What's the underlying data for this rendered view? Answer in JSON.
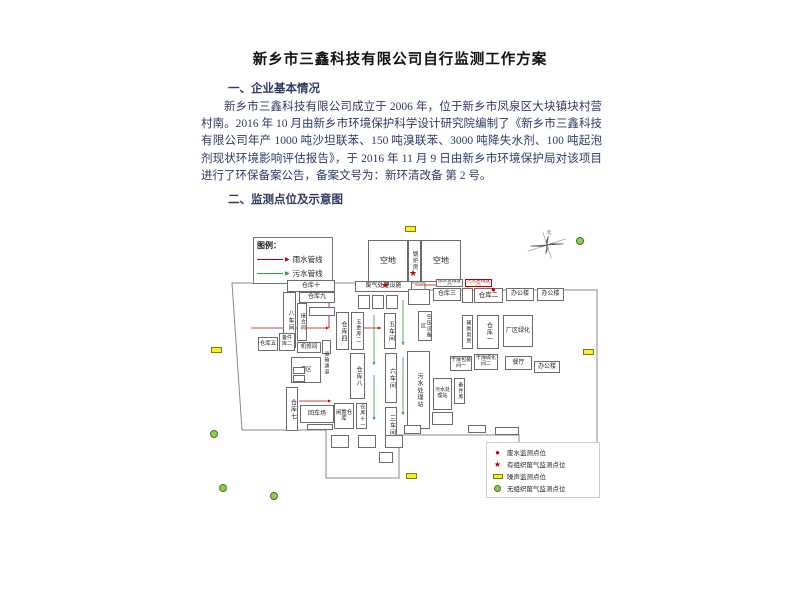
{
  "document": {
    "title": "新乡市三鑫科技有限公司自行监测工作方案",
    "section1_heading": "一、企业基本情况",
    "paragraph": "新乡市三鑫科技有限公司成立于 2006 年，位于新乡市凤泉区大块镇块村营村南。2016 年 10 月由新乡市环境保护科学设计研究院编制了《新乡市三鑫科技有限公司年产 1000 吨沙坦联苯、150 吨溴联苯、3000 吨降失水剂、100 吨起泡剂现状环境影响评估报告》，于 2016 年 11 月 9 日由新乡市环境保护局对该项目进行了环保备案公告，备案文号为：新环清改备 第 2 号。",
    "section2_heading": "二、监测点位及示意图",
    "text_color": "#2e3a66",
    "title_color": "#111111"
  },
  "diagram": {
    "palette": {
      "rain": "#c00000",
      "sewage": "#2e9e44",
      "noise_fill": "#f5ef2a",
      "noise_border": "#7f7f00",
      "fugitive_fill": "#92c94e",
      "fugitive_border": "#3c7a1f",
      "star": "#c00000",
      "dot": "#c00000",
      "outline": "#8a8a8a"
    },
    "pipe_legend": {
      "title": "图例：",
      "items": [
        {
          "label": "雨水管线",
          "color_key": "rain"
        },
        {
          "label": "污水管线",
          "color_key": "sewage"
        }
      ]
    },
    "monitoring_legend": {
      "items": [
        {
          "label": "废水监测点位",
          "symbol": "dot"
        },
        {
          "label": "有组织废气监测点位",
          "symbol": "star"
        },
        {
          "label": "噪声监测点位",
          "symbol": "noise"
        },
        {
          "label": "无组织废气监测点位",
          "symbol": "fugitive"
        }
      ]
    },
    "compass_label": "北",
    "outline": "29,68 222,68 222,75 394,75 394,237 316,237 316,220 196,220 196,263 123,263 123,215 39,215",
    "buildings": [
      {
        "l": "空地",
        "x": 165,
        "y": 25,
        "w": 40,
        "h": 42,
        "fs": 8
      },
      {
        "l": "锅炉房",
        "x": 205,
        "y": 25,
        "w": 13,
        "h": 42,
        "o": "v",
        "fs": 5.5
      },
      {
        "l": "空地",
        "x": 218,
        "y": 25,
        "w": 40,
        "h": 42,
        "fs": 8
      },
      {
        "l": "仓库十",
        "x": 84,
        "y": 65,
        "w": 48,
        "h": 12,
        "fs": 6
      },
      {
        "l": "仓库九",
        "x": 96,
        "y": 77,
        "w": 36,
        "h": 11,
        "fs": 6
      },
      {
        "l": "八车间",
        "x": 80,
        "y": 77,
        "w": 13,
        "h": 56,
        "o": "v",
        "fs": 6
      },
      {
        "l": "接合间",
        "x": 94,
        "y": 88,
        "w": 10,
        "h": 38,
        "o": "v",
        "fs": 5
      },
      {
        "l": "",
        "x": 106,
        "y": 92,
        "w": 26,
        "h": 9
      },
      {
        "l": "仓库五",
        "x": 55,
        "y": 122,
        "w": 20,
        "h": 14,
        "fs": 5.5
      },
      {
        "l": "备件库二",
        "x": 76,
        "y": 118,
        "w": 16,
        "h": 18,
        "fs": 5
      },
      {
        "l": "机修间",
        "x": 94,
        "y": 127,
        "w": 24,
        "h": 11,
        "fs": 5.5
      },
      {
        "l": "",
        "x": 119,
        "y": 125,
        "w": 9,
        "h": 14
      },
      {
        "l": "罐区",
        "x": 88,
        "y": 142,
        "w": 30,
        "h": 26,
        "fs": 5.5
      },
      {
        "l": "",
        "x": 90,
        "y": 152,
        "w": 12,
        "h": 7
      },
      {
        "l": "",
        "x": 90,
        "y": 160,
        "w": 12,
        "h": 7
      },
      {
        "l": "仓库七",
        "x": 83,
        "y": 172,
        "w": 12,
        "h": 44,
        "o": "v",
        "fs": 6
      },
      {
        "l": "回车场",
        "x": 97,
        "y": 190,
        "w": 34,
        "h": 18,
        "fs": 6
      },
      {
        "l": "",
        "x": 104,
        "y": 209,
        "w": 26,
        "h": 6
      },
      {
        "l": "运输通道",
        "x": 118,
        "y": 120,
        "w": 9,
        "h": 56,
        "o": "v",
        "fs": 5,
        "nb": true
      },
      {
        "l": "仓库四",
        "x": 133,
        "y": 97,
        "w": 13,
        "h": 38,
        "o": "v",
        "fs": 6
      },
      {
        "l": "五金库二",
        "x": 148,
        "y": 97,
        "w": 13,
        "h": 38,
        "o": "v",
        "fs": 5
      },
      {
        "l": "废气处理设施",
        "x": 152,
        "y": 66,
        "w": 57,
        "h": 11,
        "fs": 6
      },
      {
        "l": "",
        "x": 155,
        "y": 80,
        "w": 12,
        "h": 14
      },
      {
        "l": "",
        "x": 169,
        "y": 80,
        "w": 12,
        "h": 14
      },
      {
        "l": "",
        "x": 183,
        "y": 80,
        "w": 12,
        "h": 14
      },
      {
        "l": "五车间",
        "x": 181,
        "y": 98,
        "w": 12,
        "h": 36,
        "o": "v",
        "fs": 6
      },
      {
        "l": "仓库八",
        "x": 147,
        "y": 138,
        "w": 15,
        "h": 46,
        "o": "v",
        "fs": 6
      },
      {
        "l": "六车间",
        "x": 182,
        "y": 138,
        "w": 12,
        "h": 50,
        "o": "v",
        "fs": 6
      },
      {
        "l": "三车间",
        "x": 182,
        "y": 192,
        "w": 12,
        "h": 36,
        "o": "v",
        "fs": 6
      },
      {
        "l": "闲置仓库",
        "x": 131,
        "y": 188,
        "w": 20,
        "h": 26,
        "fs": 5.5
      },
      {
        "l": "仓库十一",
        "x": 153,
        "y": 188,
        "w": 11,
        "h": 26,
        "o": "v",
        "fs": 5
      },
      {
        "l": "",
        "x": 128,
        "y": 220,
        "w": 18,
        "h": 13
      },
      {
        "l": "",
        "x": 155,
        "y": 220,
        "w": 18,
        "h": 13
      },
      {
        "l": "",
        "x": 182,
        "y": 220,
        "w": 18,
        "h": 13
      },
      {
        "l": "",
        "x": 176,
        "y": 237,
        "w": 14,
        "h": 11
      },
      {
        "l": "",
        "x": 205,
        "y": 74,
        "w": 22,
        "h": 16
      },
      {
        "l": "仓库三",
        "x": 230,
        "y": 73,
        "w": 28,
        "h": 13,
        "fs": 6
      },
      {
        "l": "",
        "x": 259,
        "y": 73,
        "w": 11,
        "h": 15
      },
      {
        "l": "仓库二",
        "x": 271,
        "y": 73,
        "w": 29,
        "h": 15,
        "fs": 6.5
      },
      {
        "l": "办公楼",
        "x": 303,
        "y": 73,
        "w": 28,
        "h": 13,
        "fs": 6
      },
      {
        "l": "办公楼",
        "x": 334,
        "y": 73,
        "w": 27,
        "h": 13,
        "fs": 6
      },
      {
        "l": "雨水总排放口",
        "x": 233,
        "y": 64,
        "w": 27,
        "h": 8,
        "fs": 4.5
      },
      {
        "l": "污水总排放口",
        "x": 262,
        "y": 64,
        "w": 27,
        "h": 8,
        "fs": 4.5,
        "c": "red"
      },
      {
        "l": "空压设备区",
        "x": 215,
        "y": 96,
        "w": 14,
        "h": 30,
        "o": "v",
        "fs": 5
      },
      {
        "l": "辅助用房",
        "x": 259,
        "y": 100,
        "w": 11,
        "h": 34,
        "o": "v",
        "fs": 5
      },
      {
        "l": "仓库一",
        "x": 274,
        "y": 100,
        "w": 22,
        "h": 34,
        "o": "v",
        "fs": 6
      },
      {
        "l": "厂区绿化",
        "x": 300,
        "y": 100,
        "w": 30,
        "h": 32,
        "fs": 6
      },
      {
        "l": "干燥包装间一",
        "x": 247,
        "y": 141,
        "w": 22,
        "h": 15,
        "fs": 5
      },
      {
        "l": "干燥硫化间二",
        "x": 271,
        "y": 139,
        "w": 24,
        "h": 16,
        "fs": 5
      },
      {
        "l": "餐厅",
        "x": 302,
        "y": 141,
        "w": 27,
        "h": 14,
        "fs": 6
      },
      {
        "l": "办公楼",
        "x": 331,
        "y": 146,
        "w": 26,
        "h": 12,
        "fs": 6
      },
      {
        "l": "污水处理站",
        "x": 204,
        "y": 136,
        "w": 23,
        "h": 78,
        "o": "v",
        "fs": 6
      },
      {
        "l": "污水处理站",
        "x": 230,
        "y": 163,
        "w": 19,
        "h": 32,
        "fs": 5
      },
      {
        "l": "备件库",
        "x": 251,
        "y": 163,
        "w": 11,
        "h": 26,
        "o": "v",
        "fs": 5
      },
      {
        "l": "",
        "x": 229,
        "y": 197,
        "w": 21,
        "h": 13
      },
      {
        "l": "",
        "x": 201,
        "y": 210,
        "w": 17,
        "h": 9
      },
      {
        "l": "",
        "x": 265,
        "y": 210,
        "w": 18,
        "h": 8
      },
      {
        "l": "",
        "x": 292,
        "y": 212,
        "w": 24,
        "h": 8
      }
    ],
    "markers": [
      {
        "t": "noise",
        "x": 202,
        "y": 11
      },
      {
        "t": "noise",
        "x": 8,
        "y": 132
      },
      {
        "t": "noise",
        "x": 380,
        "y": 134
      },
      {
        "t": "noise",
        "x": 203,
        "y": 258
      },
      {
        "t": "fugitive",
        "x": 373,
        "y": 22
      },
      {
        "t": "fugitive",
        "x": 7,
        "y": 215
      },
      {
        "t": "fugitive",
        "x": 16,
        "y": 269
      },
      {
        "t": "fugitive",
        "x": 67,
        "y": 277
      },
      {
        "t": "star",
        "x": 206,
        "y": 54
      },
      {
        "t": "star",
        "x": 178,
        "y": 66
      },
      {
        "t": "dot",
        "x": 288,
        "y": 71
      }
    ],
    "pipelines": [
      {
        "c": "rain",
        "pts": [
          48,
          113,
          126,
          113
        ]
      },
      {
        "c": "rain",
        "pts": [
          126,
          113,
          126,
          82
        ]
      },
      {
        "c": "rain",
        "pts": [
          96,
          186,
          128,
          186
        ]
      },
      {
        "c": "rain",
        "pts": [
          212,
          70,
          236,
          70
        ]
      },
      {
        "c": "rain",
        "pts": [
          152,
          113,
          178,
          113
        ]
      },
      {
        "c": "sewage",
        "pts": [
          171,
          100,
          171,
          150
        ]
      },
      {
        "c": "sewage",
        "pts": [
          171,
          160,
          171,
          205
        ]
      },
      {
        "c": "sewage",
        "pts": [
          200,
          85,
          200,
          130
        ]
      },
      {
        "c": "sewage",
        "pts": [
          200,
          142,
          200,
          200
        ]
      },
      {
        "c": "sewage",
        "pts": [
          265,
          88,
          265,
          72
        ]
      }
    ]
  }
}
